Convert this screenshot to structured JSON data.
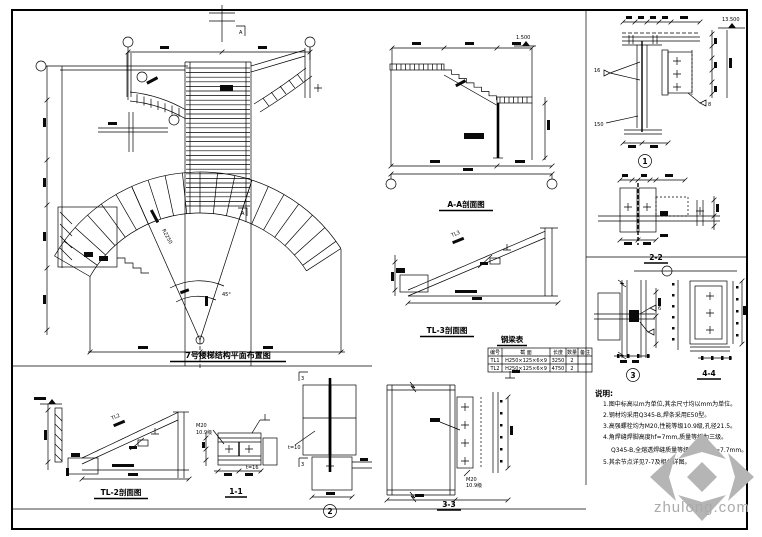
{
  "sheet": {
    "background": "#ffffff",
    "line_color": "#000000"
  },
  "plan": {
    "title": "7号楼梯结构平面布置图",
    "marker_a": "A",
    "radius_label": "R2250",
    "angle_label": "45°"
  },
  "section_aa": {
    "title": "A-A剖面图",
    "elev_label": "1.500"
  },
  "tl3": {
    "title": "TL-3剖面图",
    "beam_label": "TL3"
  },
  "tl2": {
    "title": "TL-2剖面图",
    "beam_label": "TL2"
  },
  "d11": {
    "title": "1-1",
    "bolt": "M20",
    "grade": "10.9级",
    "thk": "t=16"
  },
  "d2": {
    "num": "2",
    "marker": "3",
    "thk": "t=10"
  },
  "d33": {
    "title": "3-3",
    "bolt": "M20",
    "grade": "10.9级"
  },
  "d1": {
    "num": "1",
    "weld_left": "16",
    "plate": "150",
    "weld_right": "8",
    "elev": "13.500"
  },
  "d22": {
    "title": "2-2"
  },
  "d3": {
    "num": "3",
    "weld": "6"
  },
  "d44": {
    "title": "4-4"
  },
  "beam_table": {
    "title": "钢梁表",
    "headers": [
      "编号",
      "截  面",
      "长度",
      "数量",
      "备注"
    ],
    "rows": [
      [
        "TL1",
        "H250×125×6×9",
        "3250",
        "2",
        ""
      ],
      [
        "TL2",
        "H250×125×6×9",
        "4750",
        "2",
        ""
      ]
    ]
  },
  "notes": {
    "header": "说明:",
    "items": [
      "1.图中标高以m为单位,其余尺寸均以mm为单位。",
      "2.钢材均采用Q345-B,焊条采用E50型。",
      "3.高强螺栓均为M20,性能等级10.9级,孔径21.5。",
      "4.角焊缝焊脚高度hf=7mm,质量等级为三级。",
      "Q345-B,全熔透焊缝质量等级为二级,hf=7.7mm。",
      "5.其余节点详见7-7及相关详图。"
    ]
  },
  "watermark": {
    "text": "zhulong.com",
    "text_color": "#aaaaaa",
    "logo_color": "#b5b5b5"
  }
}
